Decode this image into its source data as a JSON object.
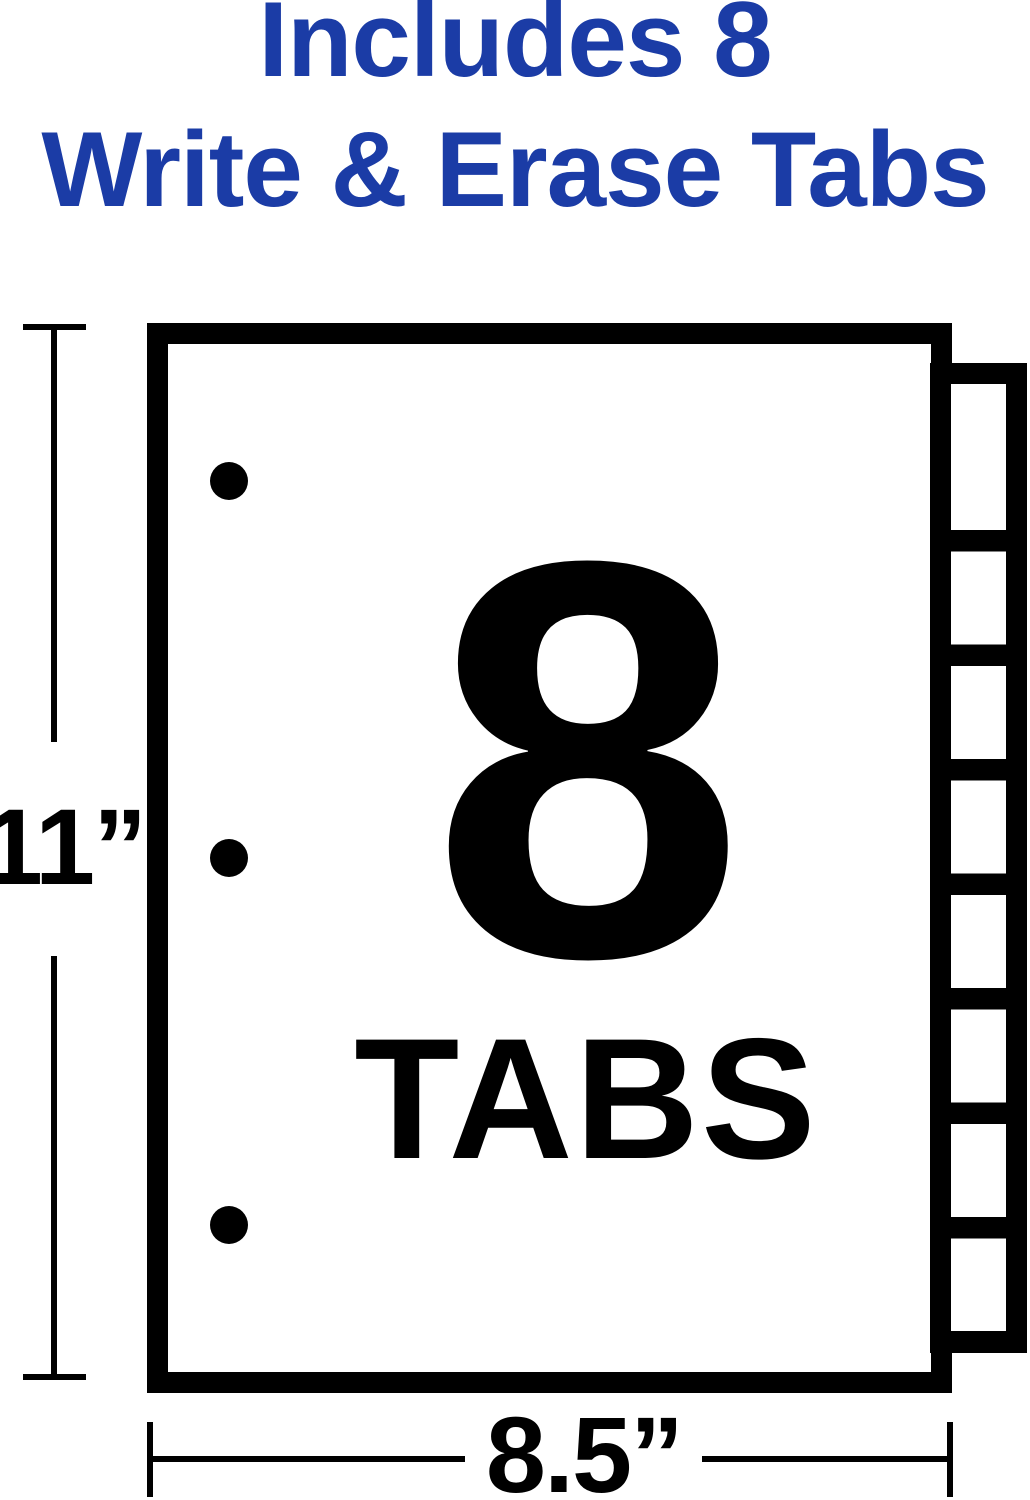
{
  "headline": {
    "line1": "Includes 8",
    "line2": "Write & Erase Tabs"
  },
  "sheet": {
    "tab_count_label": "8",
    "tabs_word": "TABS",
    "tab_slots": 8,
    "punch_holes": 3
  },
  "dimensions": {
    "height_label": "11”",
    "width_label": "8.5”"
  },
  "colors": {
    "heading_blue": "#1B3CA6",
    "ink": "#000000",
    "paper": "#FFFFFF"
  }
}
